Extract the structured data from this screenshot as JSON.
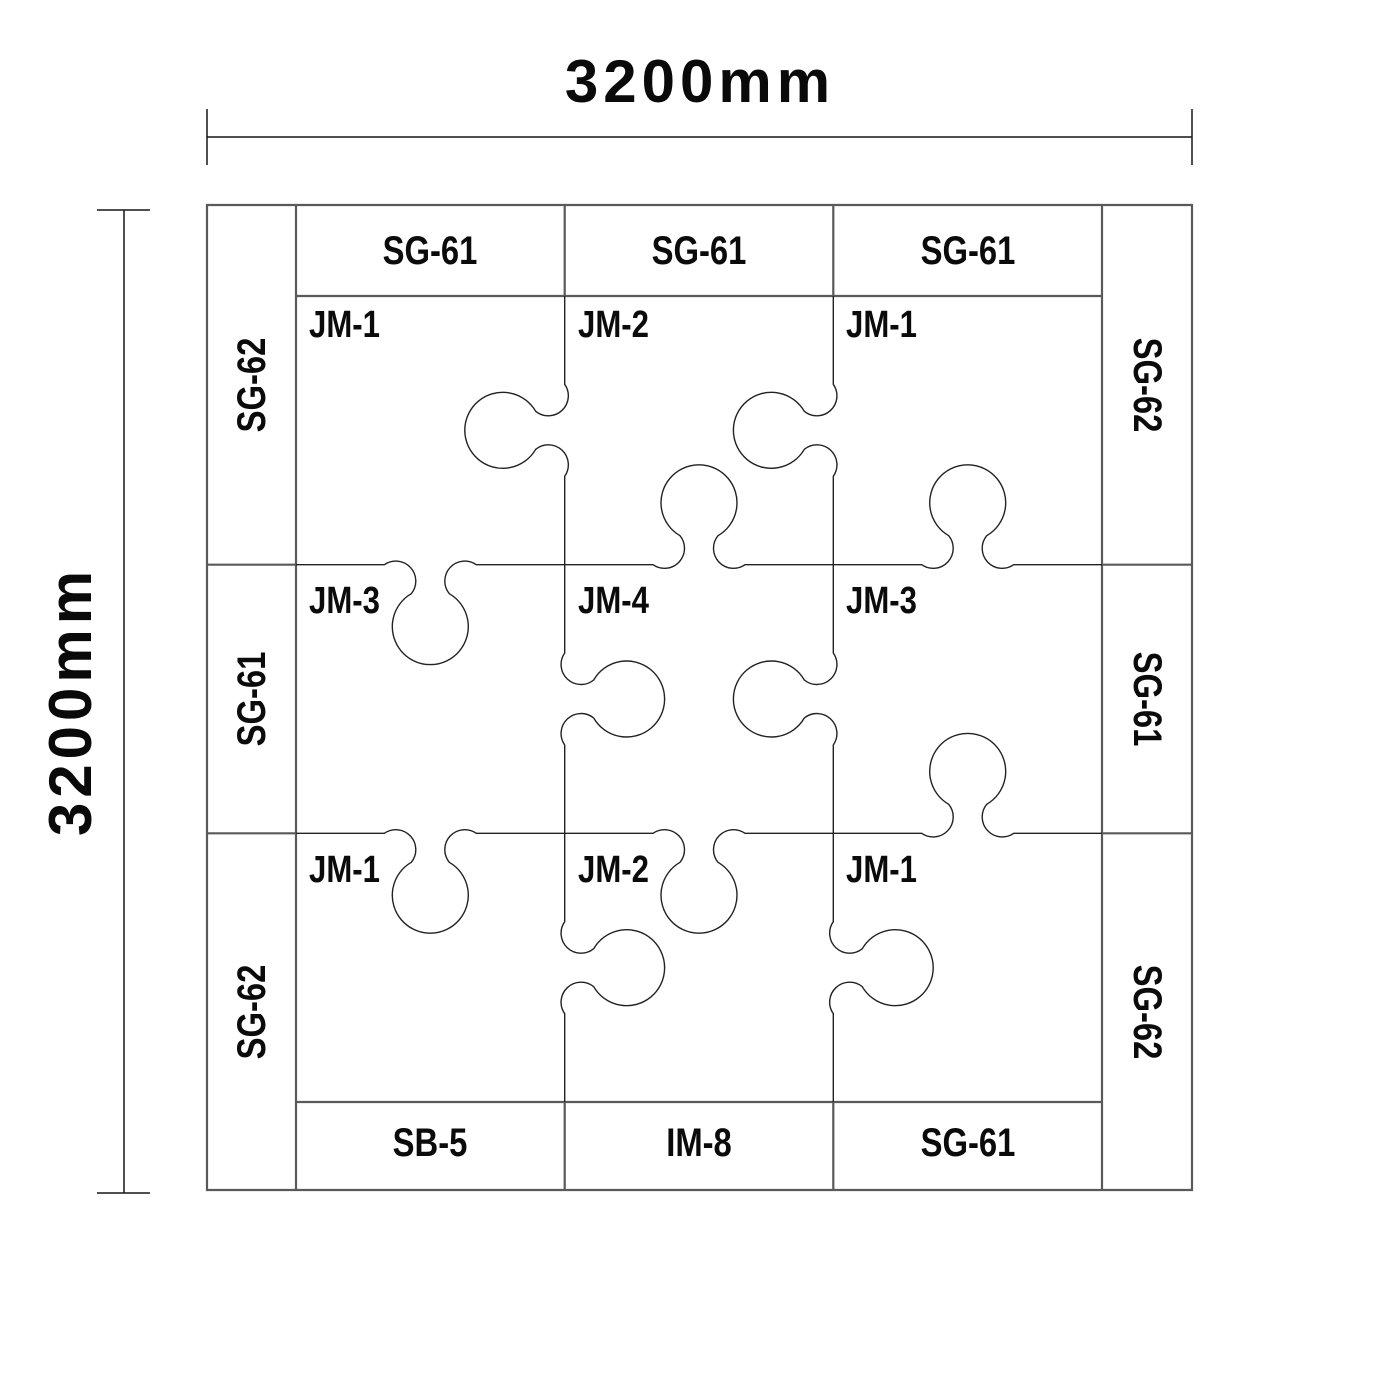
{
  "dimensions": {
    "width_label": "3200mm",
    "height_label": "3200mm"
  },
  "mat": {
    "top_strips": [
      "SG-61",
      "SG-61",
      "SG-61"
    ],
    "bottom_strips": [
      "SB-5",
      "IM-8",
      "SG-61"
    ],
    "left_strips": [
      "SG-62",
      "SG-61",
      "SG-62"
    ],
    "right_strips": [
      "SG-62",
      "SG-61",
      "SG-62"
    ],
    "pieces": [
      [
        "JM-1",
        "JM-2",
        "JM-1"
      ],
      [
        "JM-3",
        "JM-4",
        "JM-3"
      ],
      [
        "JM-1",
        "JM-2",
        "JM-1"
      ]
    ],
    "joints": {
      "vertical": [
        [
          "left",
          "right",
          "right"
        ],
        [
          "left",
          "left",
          "right"
        ]
      ],
      "horizontal": [
        [
          "down",
          "up",
          "up"
        ],
        [
          "down",
          "down",
          "up"
        ]
      ]
    },
    "geometry": {
      "outer": [
        207,
        205,
        1192,
        1190
      ],
      "inner": [
        296,
        296,
        1102,
        1102
      ],
      "dim_top_y": 137,
      "dim_left_x": 124,
      "tick_half": 28,
      "knob": {
        "neck_r": 20,
        "bulb_r": 38,
        "reach": 29,
        "span": 46,
        "tangent": 19
      }
    }
  },
  "style": {
    "grid_color": "#5a5a5a",
    "boundary_color": "#222222",
    "dim_color": "#161616",
    "text_color": "#0b0b0b",
    "background": "#ffffff"
  }
}
